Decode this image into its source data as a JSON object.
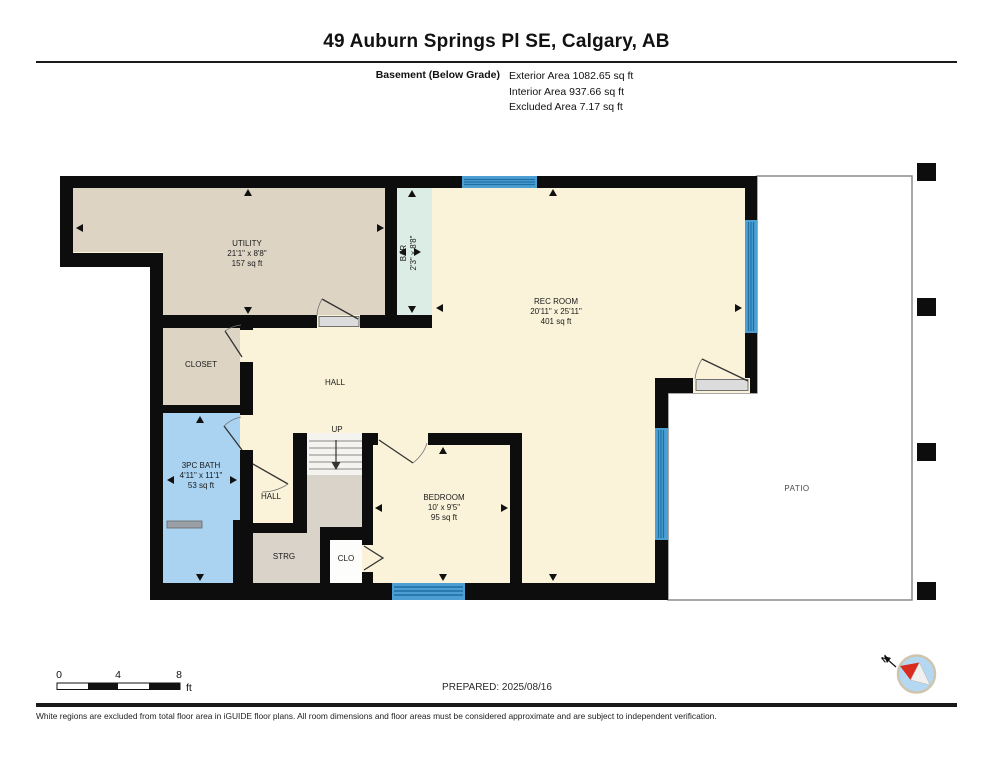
{
  "header": {
    "title": "49 Auburn Springs Pl SE, Calgary, AB",
    "floor_label": "Basement (Below Grade)",
    "exterior_area": "Exterior Area 1082.65 sq ft",
    "interior_area": "Interior Area 937.66 sq ft",
    "excluded_area": "Excluded Area 7.17 sq ft"
  },
  "rooms": {
    "utility": {
      "name": "UTILITY",
      "dims": "21'1\" x 8'8\"",
      "area": "157 sq ft"
    },
    "bar": {
      "name": "BAR",
      "dims": "2'3\" x 8'8\""
    },
    "rec_room": {
      "name": "REC ROOM",
      "dims": "20'11\" x 25'11\"",
      "area": "401 sq ft"
    },
    "closet": {
      "name": "CLOSET"
    },
    "hall": {
      "name": "HALL"
    },
    "stairs": {
      "name": "UP"
    },
    "bath": {
      "name": "3PC BATH",
      "dims": "4'11\" x 11'1\"",
      "area": "53 sq ft"
    },
    "hall_lower": {
      "name": "HALL"
    },
    "storage": {
      "name": "STRG"
    },
    "clo": {
      "name": "CLO"
    },
    "bedroom": {
      "name": "BEDROOM",
      "dims": "10' x 9'5\"",
      "area": "95 sq ft"
    },
    "patio": {
      "name": "PATIO"
    }
  },
  "scale_bar": {
    "tick0": "0",
    "tick1": "4",
    "tick2": "8",
    "unit": "ft"
  },
  "compass": {
    "north_label": "N"
  },
  "footer": {
    "prepared": "PREPARED: 2025/08/16",
    "disclaimer": "White regions are excluded from total floor area in iGUIDE floor plans. All room dimensions and floor areas must be considered approximate and are subject to independent verification."
  },
  "colors": {
    "floor_cream": "#FAF3D9",
    "room_beige": "#DDD4C4",
    "bar_mint": "#DCEDE6",
    "bath_blue": "#A9D3F0",
    "storage_gray": "#D9D3C9",
    "window_blue": "#4C9FD2",
    "window_stripe": "#1E6FA4",
    "wall_black": "#0D0D0D",
    "compass_red": "#D92B1E",
    "compass_fill": "#B5D8F2"
  }
}
